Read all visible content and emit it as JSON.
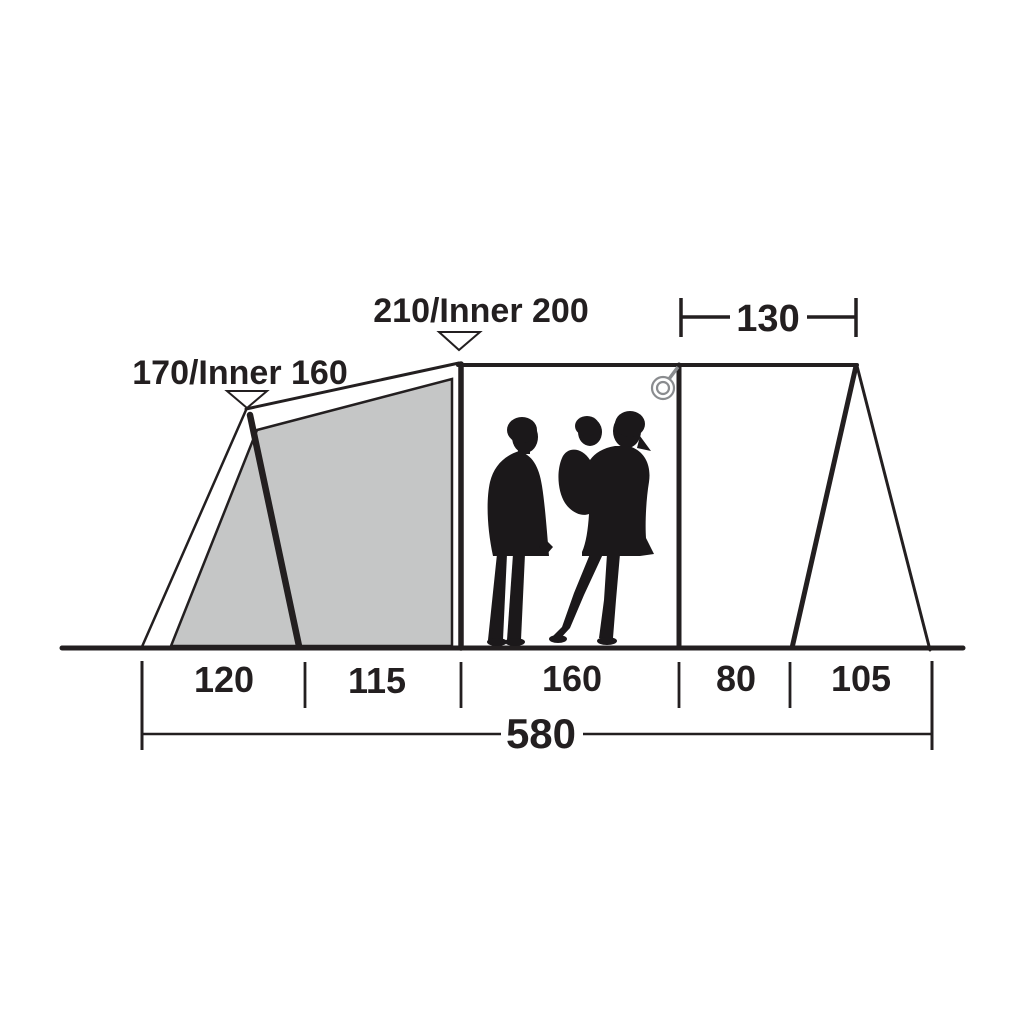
{
  "diagram": {
    "name": "tent-side-profile-dimensions",
    "colors": {
      "line": "#231f20",
      "text": "#231f20",
      "panel": "#c5c6c6",
      "silhouette": "#1b181a",
      "ring": "#8a8c8f",
      "background": "#ffffff"
    },
    "labels": {
      "front_peak_height": "170/Inner 160",
      "main_peak_height": "210/Inner 200",
      "rear_top_width": "130",
      "total_width": "580"
    },
    "floor_segments": [
      "120",
      "115",
      "160",
      "80",
      "105"
    ]
  }
}
